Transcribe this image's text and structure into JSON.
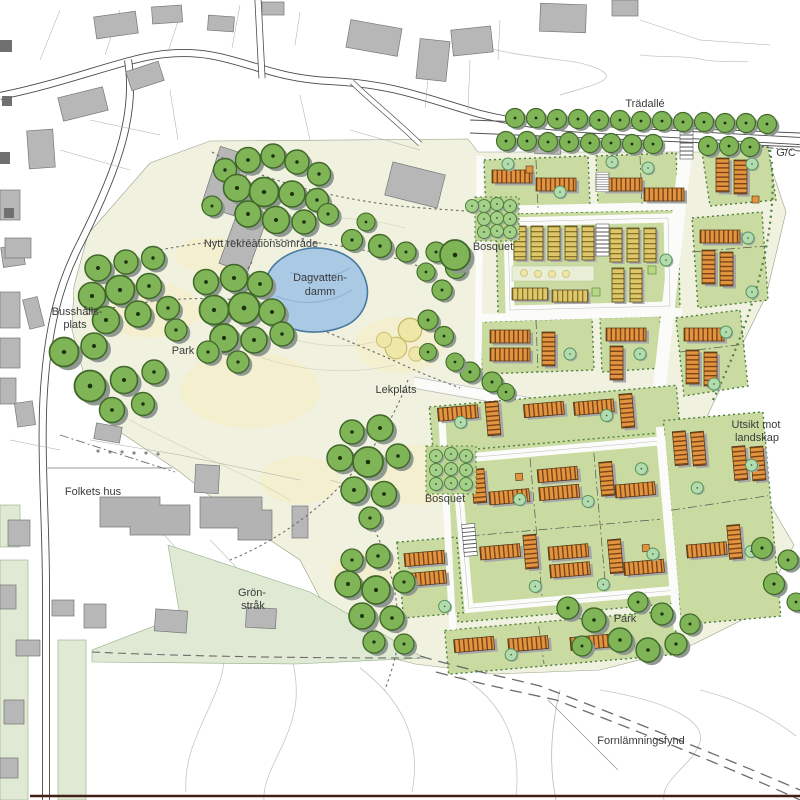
{
  "map": {
    "labels": {
      "tree_avenue": "Trädallé",
      "bike_path": "G/C",
      "recreation_area": "Nytt rekreationsområde",
      "pond_line1": "Dagvatten-",
      "pond_line2": "damm",
      "bosquet_north": "Bosquet",
      "bus_stop_line1": "Busshålls-",
      "bus_stop_line2": "plats",
      "park_west": "Park",
      "playground": "Lekplats",
      "view_line1": "Utsikt mot",
      "view_line2": "landskap",
      "community_house": "Folkets hus",
      "green_corridor_line1": "Grön-",
      "green_corridor_line2": "stråk",
      "bosquet_south": "Bosquet",
      "park_southeast": "Park",
      "ancient_remains": "Fornlämningsfynd"
    },
    "colors": {
      "tree_green": "#80b557",
      "tree_outline": "#41682a",
      "block_green": "#c9dba0",
      "block_border": "#4e7e41",
      "building_orange": "#e2943f",
      "building_yellow": "#dcc76b",
      "pond_blue": "#a9c9e5",
      "pond_border": "#48799f",
      "existing_building_gray": "#b6b7b6",
      "park_cream": "#f0f2df",
      "green_strip": "#dfe9d3",
      "label_text": "#3b3b3b"
    }
  }
}
